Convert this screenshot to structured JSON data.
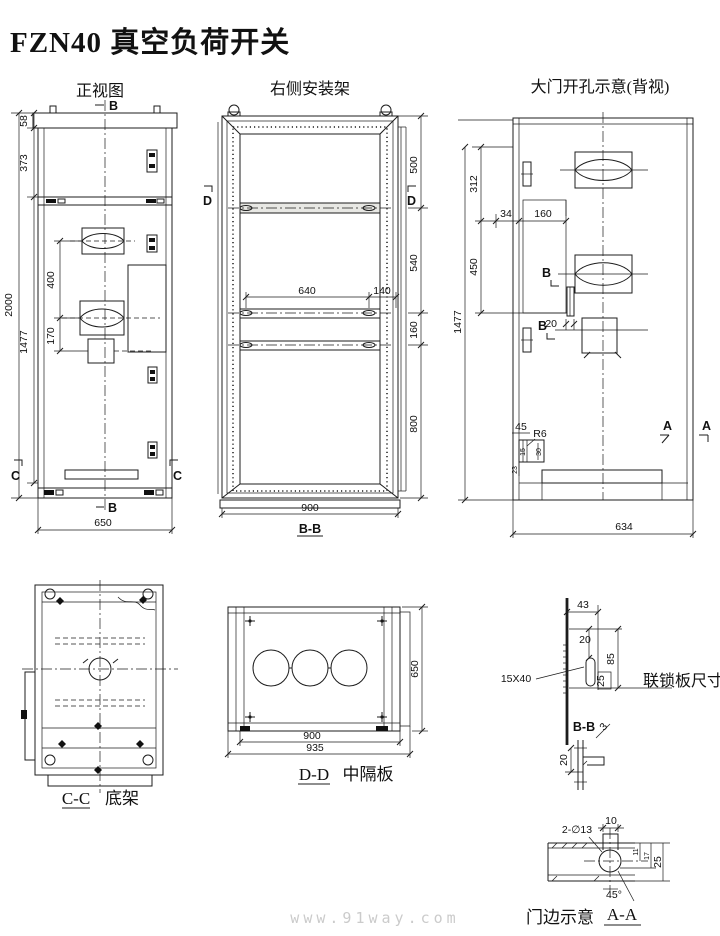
{
  "page": {
    "title": "FZN40 真空负荷开关",
    "watermark": "www.91way.com"
  },
  "front_view": {
    "label": "正视图",
    "marker_b": "B",
    "marker_c": "C",
    "dim_top_strip": "58",
    "dim_upper_panel": "373",
    "dim_total_height": "2000",
    "dim_door_height": "1477",
    "dim_handle_spacing": "400",
    "dim_lower_spacing": "170",
    "dim_width": "650"
  },
  "side_frame": {
    "label": "右侧安装架",
    "section_label": "B-B",
    "marker_d": "D",
    "dim_section1": "500",
    "dim_section2": "540",
    "dim_section3": "160",
    "dim_section4": "800",
    "dim_rail_span": "640",
    "dim_rail_edge": "140",
    "dim_width": "900"
  },
  "door_view": {
    "label": "大门开孔示意(背视)",
    "marker_a": "A",
    "marker_b": "B",
    "dim_top": "312",
    "dim_hinge_offset": "34",
    "dim_cutout_span": "160",
    "dim_mid": "450",
    "dim_height": "1477",
    "dim_bar_width": "20",
    "dim_corner": "45",
    "radius_corner": "R6",
    "dim_slot_w": "15",
    "dim_slot_h": "30",
    "dim_slot_off": "23",
    "dim_width": "634"
  },
  "bottom_frame_view": {
    "section_label": "C-C",
    "label": "底架"
  },
  "partition_view": {
    "section_label": "D-D",
    "label": "中隔板",
    "dim_height": "650",
    "dim_inner_width": "900",
    "dim_outer_width": "935"
  },
  "interlock_plate": {
    "label": "联锁板尺寸",
    "slot_size": "15X40",
    "section_label": "B-B",
    "dim_offset": "43",
    "dim_top": "20",
    "dim_length": "85",
    "dim_slot": "25",
    "chamfer": "3",
    "dim_profile": "20"
  },
  "door_edge_view": {
    "label": "门边示意",
    "section_label": "A-A",
    "hole_callout": "2-∅13",
    "angle": "45°",
    "dim_notch": "10",
    "dim_a": "11",
    "dim_b": "17",
    "dim_c": "25"
  }
}
